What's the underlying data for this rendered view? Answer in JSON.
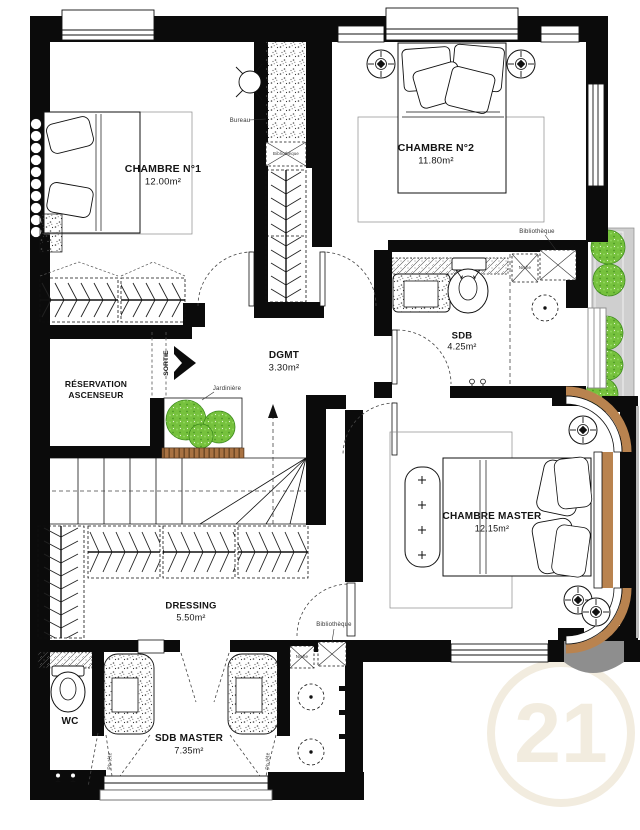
{
  "plan": {
    "rooms": {
      "chambre1": {
        "name": "CHAMBRE N°1",
        "area": "12.00m²"
      },
      "chambre2": {
        "name": "CHAMBRE N°2",
        "area": "11.80m²"
      },
      "dgmt": {
        "name": "DGMT",
        "area": "3.30m²"
      },
      "sdb": {
        "name": "SDB",
        "area": "4.25m²"
      },
      "ascenseur": {
        "line1": "RÉSERVATION",
        "line2": "ASCENSEUR"
      },
      "chambre_master": {
        "name": "CHAMBRE MASTER",
        "area": "12.15m²"
      },
      "dressing": {
        "name": "DRESSING",
        "area": "5.50m²"
      },
      "wc": {
        "name": "WC"
      },
      "sdb_master": {
        "name": "SDB MASTER",
        "area": "7.35m²"
      }
    },
    "annotations": {
      "bureau": "Bureau",
      "bibliotheque": "Bibliothèque",
      "niche": "Niche",
      "jardiniere": "Jardinière",
      "sortie": "SORTIE",
      "pb_tete": "Pb tête"
    },
    "watermark": "21",
    "colors": {
      "wall": "#0b0b0b",
      "plant_green": "#76c13d",
      "wood_tan": "#b9834f",
      "balcony_gray": "#cfcfcf",
      "watermark_cream": "#f2ecdf"
    }
  }
}
